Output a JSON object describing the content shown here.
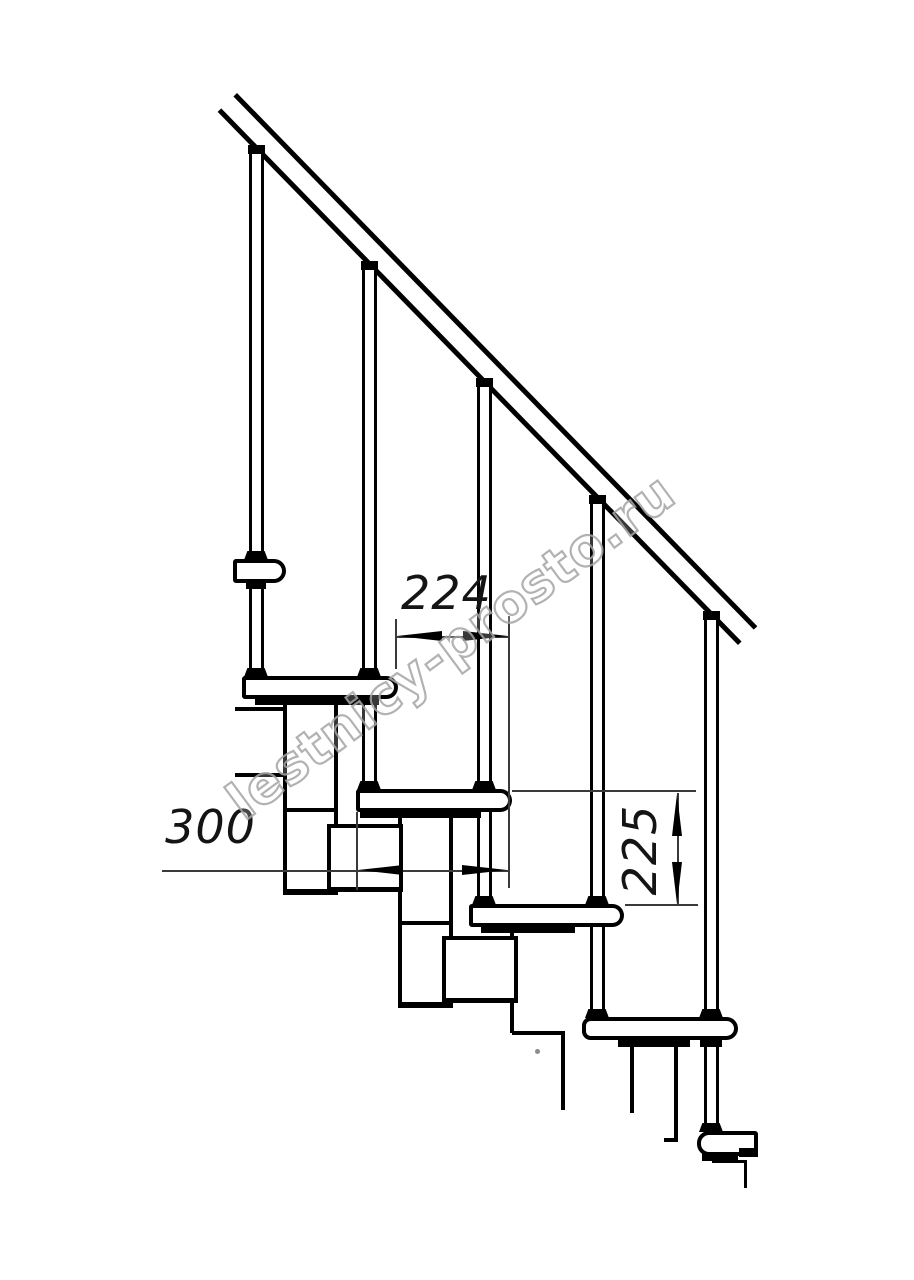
{
  "drawing": {
    "watermark": "lestnicy-prosto.ru",
    "dimensions": {
      "step_run": "224",
      "tread_depth": "300",
      "step_rise": "225"
    },
    "colors": {
      "line": "#000000",
      "dimension_line": "#3a3a3a",
      "watermark_outline": "#a5a5a5",
      "background": "#ffffff"
    }
  }
}
